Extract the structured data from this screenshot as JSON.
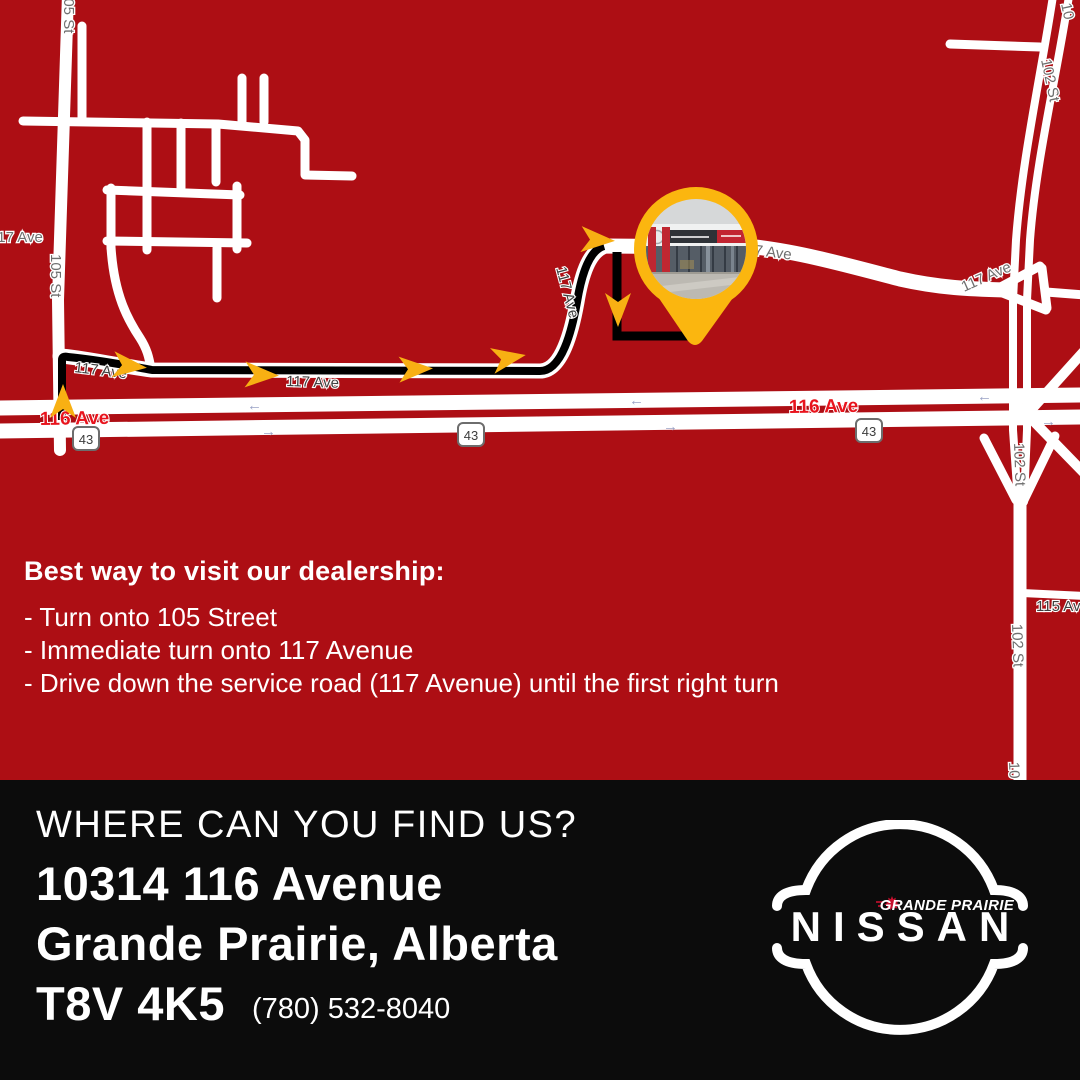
{
  "map": {
    "colors": {
      "background": "#AD0E14",
      "road": "#FFFFFF",
      "route": "#000000",
      "arrow_gold": "#F8B013",
      "pin_gold": "#FBB60F",
      "label_grey": "#6F6F6F",
      "label_red": "#E8141D"
    },
    "labels": {
      "st105_top": "105 St",
      "st105_mid": "105 St",
      "ave117_west": "117 Ave",
      "ave117_service_1": "117 Ave",
      "ave117_service_2": "117 Ave",
      "ave117_curve": "117 Ave",
      "ave117_at_pin": "7 Ave",
      "ave117_east": "117 Ave",
      "ave116_west": "116 Ave",
      "ave116_east": "116 Ave",
      "st102_top": "102 St",
      "st102_mid": "102 St",
      "st102_south": "102 St",
      "ave115": "115 Ave",
      "partial_top_right": "10",
      "partial_bottom_right": "10"
    },
    "highway_shield": "43",
    "oneway_left": "←",
    "oneway_right": "→"
  },
  "directions": {
    "heading": "Best way to visit our dealership:",
    "steps": [
      "- Turn onto 105 Street",
      "- Immediate turn onto 117 Avenue",
      "- Drive down the service road (117 Avenue) until the first right turn"
    ]
  },
  "footer": {
    "heading": "WHERE CAN YOU FIND US?",
    "address_line1": "10314 116 Avenue",
    "address_line2": "Grande Prairie, Alberta",
    "postal_code": "T8V 4K5",
    "phone": "(780) 532-8040",
    "logo": {
      "brand": "NISSAN",
      "dealer": "GRANDE PRAIRIE",
      "accent": "#C8102E"
    }
  }
}
